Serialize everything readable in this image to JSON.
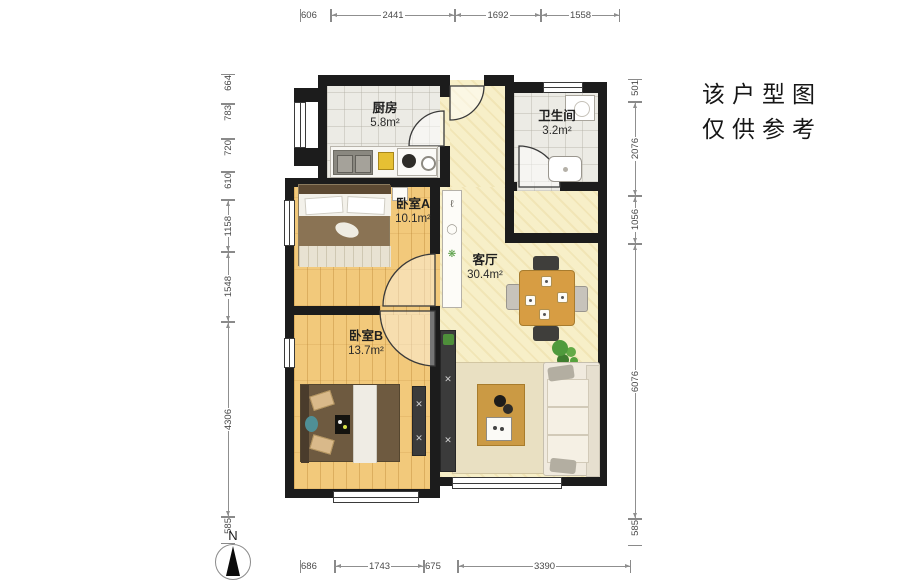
{
  "disclaimer": {
    "line1": "该户型图",
    "line2": "仅供参考"
  },
  "compass": {
    "north_label": "N"
  },
  "rooms": {
    "kitchen": {
      "name": "厨房",
      "area": "5.8m²"
    },
    "bathroom": {
      "name": "卫生间",
      "area": "3.2m²"
    },
    "bedroom_a": {
      "name": "卧室A",
      "area": "10.1m²"
    },
    "living_room": {
      "name": "客厅",
      "area": "30.4m²"
    },
    "bedroom_b": {
      "name": "卧室B",
      "area": "13.7m²"
    }
  },
  "dimensions_mm": {
    "top": [
      "606",
      "2441",
      "1692",
      "1558"
    ],
    "bottom": [
      "686",
      "1743",
      "675",
      "3390"
    ],
    "left": [
      "664",
      "783",
      "720",
      "610",
      "1158",
      "1548",
      "4306",
      "585"
    ],
    "right": [
      "501",
      "2076",
      "1056",
      "6076",
      "585"
    ]
  },
  "colors": {
    "wall": "#1c1c1c",
    "wood_floor": "#f2c97b",
    "tile_floor": "#ecebe5",
    "living_floor": "#f7efc8",
    "dimension_text": "#4a4a4a",
    "label_text": "#1f1f1f",
    "plant_green": "#4f9a3c",
    "table_wood": "#d79d43"
  }
}
